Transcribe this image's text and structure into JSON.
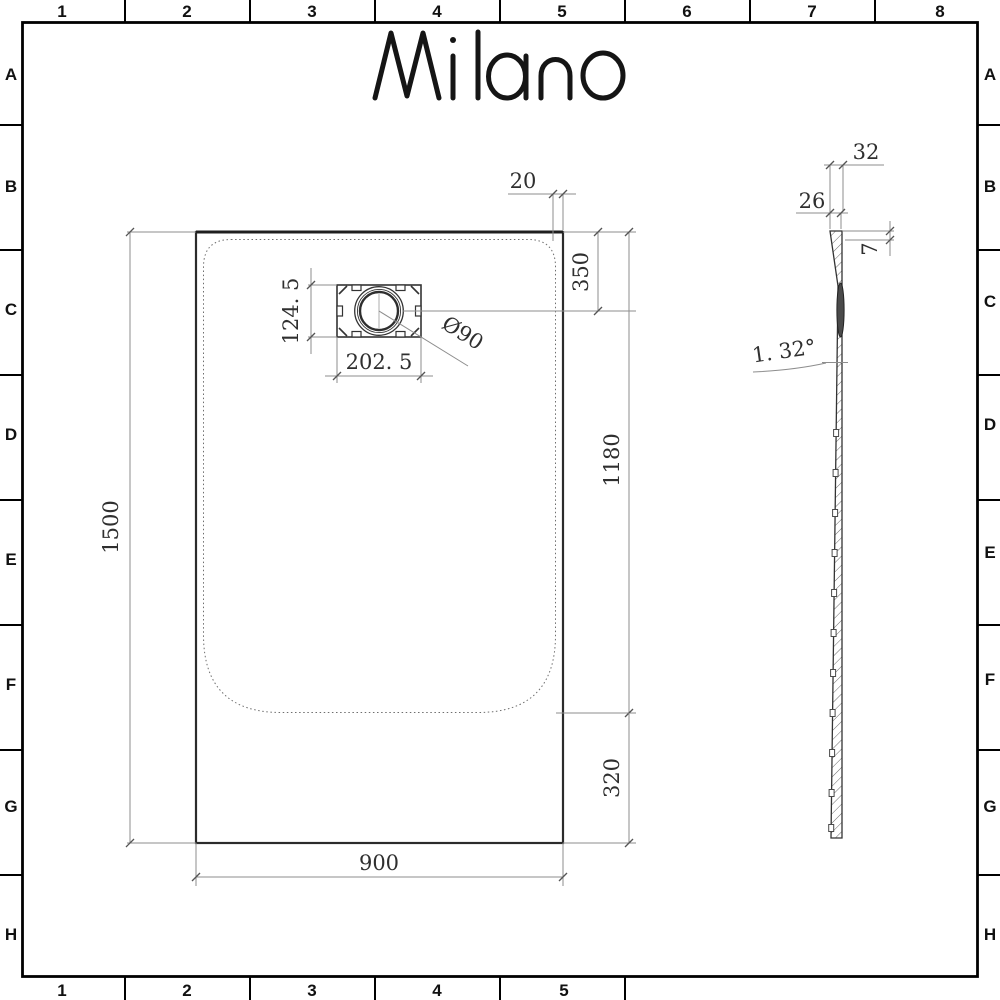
{
  "brand": {
    "name": "Milano"
  },
  "grid": {
    "cols": [
      "1",
      "2",
      "3",
      "4",
      "5",
      "6",
      "7",
      "8"
    ],
    "bottom_cols": [
      "1",
      "2",
      "3",
      "4",
      "5"
    ],
    "rows": [
      "A",
      "B",
      "C",
      "D",
      "E",
      "F",
      "G",
      "H"
    ]
  },
  "front": {
    "width": "900",
    "height": "1500",
    "rim_offset": "20",
    "top_to_drain_center": "350",
    "top_to_basin_end": "1180",
    "basin_end_to_edge": "320",
    "drain_width": "202. 5",
    "drain_height": "124. 5",
    "drain_diameter": "Ø90"
  },
  "side": {
    "overall_depth": "32",
    "rim_width": "26",
    "edge_lip": "7",
    "base_angle": "1. 32°"
  },
  "colors": {
    "line": "#2b2b2b",
    "dim": "#8d8d8d",
    "text": "#2f2f2f"
  }
}
